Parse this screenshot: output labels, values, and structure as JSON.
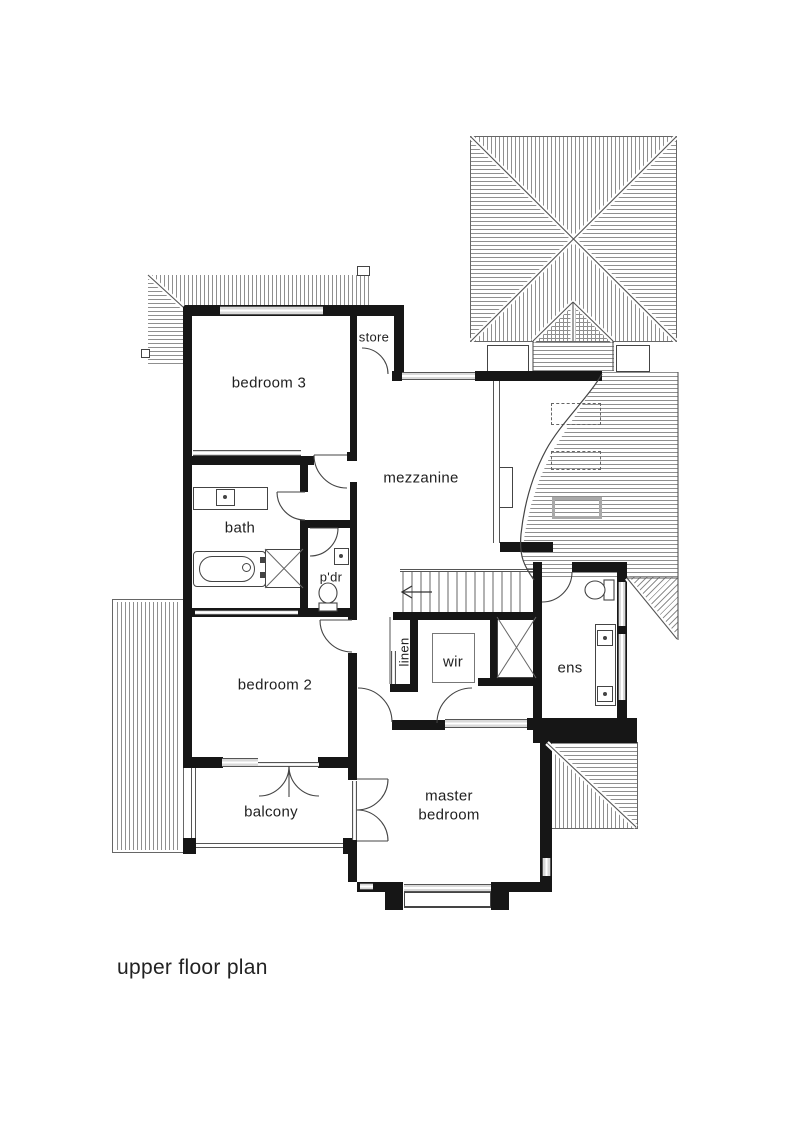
{
  "title": "upper floor plan",
  "rooms": {
    "bedroom3": "bedroom 3",
    "store": "store",
    "mezzanine": "mezzanine",
    "bath": "bath",
    "pdr": "p'dr",
    "linen": "linen",
    "wir": "wir",
    "ens": "ens",
    "bedroom2": "bedroom 2",
    "balcony": "balcony",
    "master": "master bedroom"
  },
  "colors": {
    "wall": "#161616",
    "line": "#444444",
    "hatch": "#8f8f8f",
    "window": "#d9d9d9"
  }
}
